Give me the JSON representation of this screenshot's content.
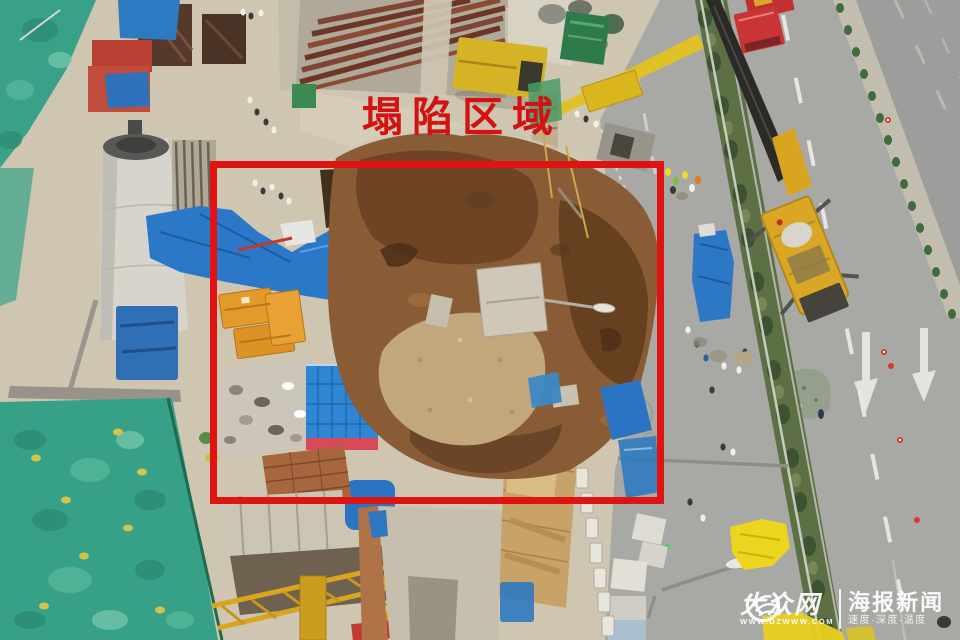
{
  "annotation": {
    "title": "塌陷区域",
    "title_color": "#d31313",
    "box_color": "#e01313"
  },
  "watermark": {
    "site_name": "大众网",
    "site_url": "WWW.DZWWW.COM",
    "brand": "海报新闻",
    "slogan": "速度·深度·温度",
    "color": "#ffffff"
  },
  "palette": {
    "annotation_red": "#e01313",
    "tarp_blue": "#2b78c8",
    "crane_yellow": "#d9a725",
    "netting_green": "#37a188",
    "collapse_dirt_brown": "#8a5c36",
    "road_gray": "#a6a6a4",
    "fire_truck_red": "#c93536"
  }
}
